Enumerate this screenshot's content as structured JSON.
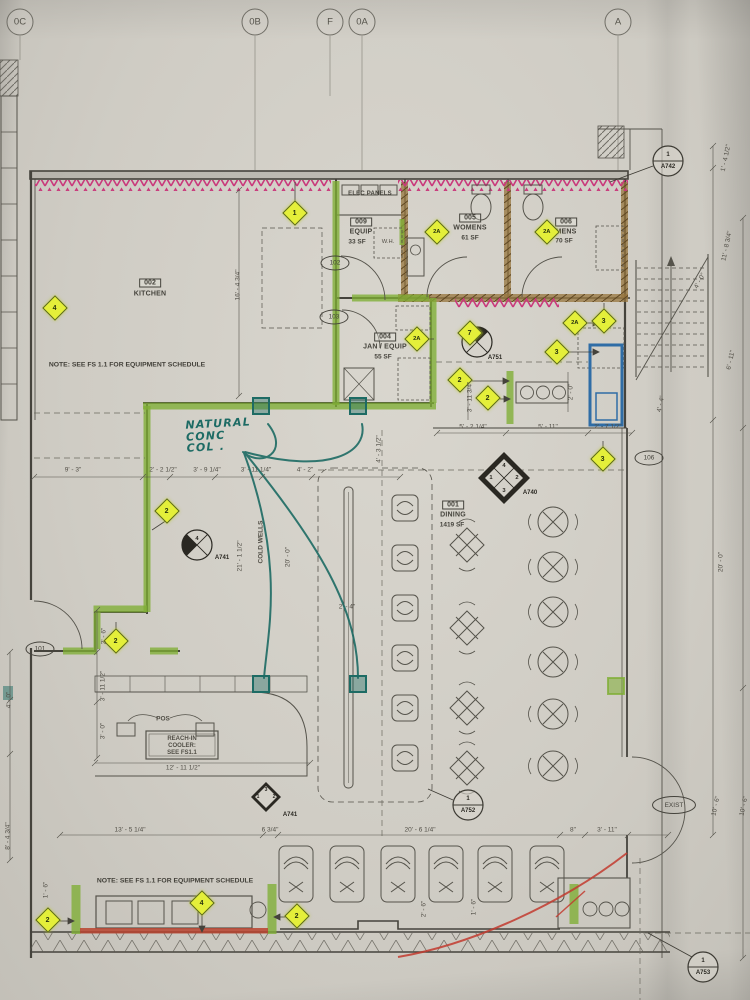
{
  "grid_bubbles": [
    "0C",
    "0B",
    "F",
    "0A",
    "A"
  ],
  "rooms": {
    "kitchen": {
      "number": "002",
      "name": "KITCHEN"
    },
    "equip": {
      "number": "009",
      "name": "EQUIP",
      "area": "33 SF"
    },
    "womens": {
      "number": "005",
      "name": "WOMENS",
      "area": "61 SF"
    },
    "mens": {
      "number": "006",
      "name": "MENS",
      "area": "70 SF"
    },
    "jan": {
      "number": "004",
      "name": "JAN / EQUIP",
      "area": "55 SF"
    },
    "dining": {
      "number": "001",
      "name": "DINING",
      "area": "1419 SF"
    }
  },
  "labels": {
    "elec_panels": "ELEC PANELS",
    "water_heater": "W.H.",
    "pos": "POS",
    "reach_in_1": "REACH-IN",
    "reach_in_2": "COOLER:",
    "reach_in_3": "SEE FS1.1",
    "cold_wells": "COLD WELLS",
    "exist": "EXIST",
    "note": "NOTE: SEE FS 1.1 FOR EQUIPMENT SCHEDULE",
    "handwriting_1": "NATURAL",
    "handwriting_2": "CONC",
    "handwriting_3": "COL ."
  },
  "door_tags": {
    "k101": "101",
    "k102": "102",
    "k103": "103",
    "k106": "106"
  },
  "ref_tags": {
    "a742_num": "1",
    "a742_sheet": "A742",
    "a752_num": "1",
    "a752_sheet": "A752",
    "a753_num": "1",
    "a753_sheet": "A753",
    "a740_sheet": "A740",
    "a740_top": "4",
    "a740_left": "1",
    "a740_right": "2",
    "a740_bottom": "3",
    "a741_plan_num": "4",
    "a741_plan_sheet": "A741",
    "a741_bot_top": "3",
    "a741_bot_left": "1",
    "a741_bot_right": "2",
    "a741_bot_sheet": "A741",
    "a751_sheet": "A751"
  },
  "keynotes": [
    "1",
    "4",
    "2A",
    "2A",
    "2A",
    "2A",
    "3",
    "3",
    "3",
    "2",
    "2",
    "2",
    "2",
    "7",
    "4",
    "2",
    "2"
  ],
  "dims": [
    "16' - 4 3/4\"",
    "1' - 4 1/2\"",
    "11' - 8 3/4\"",
    "4' - 0\"",
    "6' - 11\"",
    "4' - 4\"",
    "3' - 11 3/4\"",
    "2' - 0\"",
    "5' - 2 1/4\"",
    "5' - 11\"",
    "2' - 7 1/2\"",
    "9' - 3\"",
    "2' - 2 1/2\"",
    "3' - 9 1/4\"",
    "3' - 11 1/4\"",
    "4' - 2\"",
    "4' - 3 1/2\"",
    "21' - 1 1/2\"",
    "20' - 0\"",
    "2' - 4\"",
    "2' - 6\"",
    "3' - 11 1/2\"",
    "3' - 0\"",
    "12' - 11 1/2\"",
    "13' - 5 1/4\"",
    "6 3/4\"",
    "20' - 6 1/4\"",
    "8\"",
    "3' - 11\"",
    "10' - 6\"",
    "10' - 6\"",
    "20' - 0\"",
    "4' - 0\"",
    "8' - 4 3/4\"",
    "1' - 6\"",
    "2' - 6\"",
    "1' - 6\""
  ],
  "colors": {
    "highlight_green": "#7fae35",
    "highlight_pink": "#c9397b",
    "highlight_yellow": "#e4ef3a",
    "marker_teal": "#1d6b64",
    "highlight_blue": "#2f6da6",
    "highlight_red": "#c23b2f"
  }
}
